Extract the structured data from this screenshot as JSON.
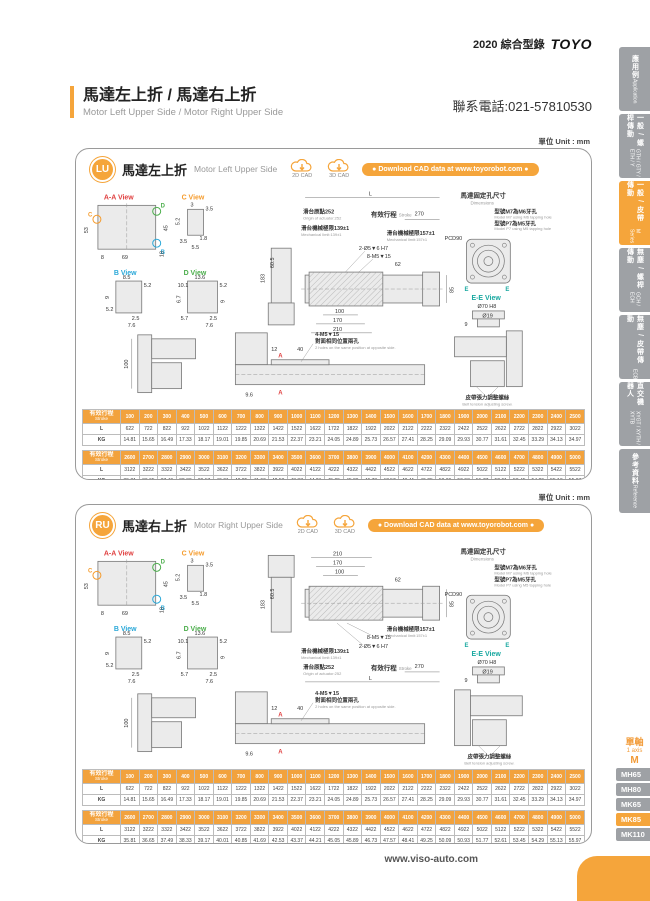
{
  "page": {
    "header": {
      "catalog_year_name": "2020 綜合型錄",
      "brand": "TOYO",
      "phone": "聯系電話:021-57810530"
    },
    "title": {
      "zh": "馬達左上折 / 馬達右上折",
      "en": "Motor Left Upper Side / Motor Right Upper Side"
    },
    "footer": {
      "website": "www.viso-auto.com"
    }
  },
  "sidebar": {
    "tabs": [
      {
        "zh": "應用例",
        "en": "Application",
        "active": false
      },
      {
        "zh": "一般 / 螺桿傳動",
        "en": "GTH / GTY / ETH / Y",
        "active": false
      },
      {
        "zh": "一般 / 皮帶傳動",
        "en": "M Series",
        "active": true
      },
      {
        "zh": "無塵 / 螺桿傳動",
        "en": "GCH / ECH",
        "active": false
      },
      {
        "zh": "無塵 / 皮帶傳動",
        "en": "ECB",
        "active": false
      },
      {
        "zh": "直交機器人",
        "en": "XYGT / XYTH / XYTB",
        "active": false
      },
      {
        "zh": "參考資料",
        "en": "Reference",
        "active": false
      }
    ]
  },
  "series_nav": {
    "group_zh": "單軸",
    "group_en": "1 axis",
    "series": "M",
    "models": [
      "MH65",
      "MH80",
      "MK65",
      "MK85",
      "MK110"
    ],
    "active_model": "MK85"
  },
  "panels": [
    {
      "badge": "LU",
      "title_zh": "馬達左上折",
      "title_en": "Motor Left Upper Side",
      "unit": "單位 Unit : mm",
      "cad_2d": "2D CAD",
      "cad_3d": "3D CAD",
      "download": "● Download CAD data at www.toyorobot.com ●"
    },
    {
      "badge": "RU",
      "title_zh": "馬達右上折",
      "title_en": "Motor Right Upper Side",
      "unit": "單位 Unit : mm",
      "cad_2d": "2D CAD",
      "cad_3d": "3D CAD",
      "download": "● Download CAD data at www.toyorobot.com ●"
    }
  ],
  "drawing": {
    "views": {
      "aa": "A-A View",
      "b": "B View",
      "c": "C View",
      "d": "D View",
      "ee": "E-E View"
    },
    "markers": {
      "a": "A",
      "b": "B",
      "c": "C",
      "d": "D",
      "e": "E"
    },
    "aa": {
      "left": "53",
      "right": "45",
      "b1": "8",
      "b2": "69",
      "b3": "18"
    },
    "c": {
      "d1": "3",
      "d2": "3.5",
      "d3": "5.2",
      "d4": "3.5",
      "d5": "1.8",
      "d6": "5.5"
    },
    "b": {
      "d1": "8.5",
      "d2": "5.2",
      "d3": "9",
      "d4": "5.2",
      "d5": "2.5",
      "d6": "7.6"
    },
    "d": {
      "d1": "13.6",
      "d2": "10.1",
      "d3": "5.2",
      "d4": "6.7",
      "d5": "9",
      "d6": "5.7",
      "d7": "2.5",
      "d8": "7.6"
    },
    "side": {
      "h": "183",
      "w": "60.5"
    },
    "main": {
      "overall": "L",
      "stroke_zh": "有效行程",
      "stroke_en": "Stroke",
      "right_len": "270",
      "origin_zh": "滑台原點252",
      "origin_en": "Origin of actuator:252",
      "limit_l_zh": "滑台機械極限139±1",
      "limit_l_en": "Mechanical limit:139±1",
      "limit_r_zh": "滑台機械極限157±1",
      "limit_r_en": "Mechanical limit:157±1",
      "callout_holes": "2-Ø5▼6 H7",
      "callout_taps": "8-M5▼15",
      "dim62": "62",
      "chain": [
        "100",
        "170",
        "210"
      ],
      "height": "85"
    },
    "mount": {
      "title_zh": "馬達固定孔尺寸",
      "title_en": "Dimensions",
      "note1_zh": "型號M7為M6牙孔",
      "note1_en": "Model M7 using M6 tapping hole",
      "note2_zh": "型號P7為M5牙孔",
      "note2_en": "Model P7 using M5 tapping hole",
      "pcd": "PCD90",
      "dia1": "Ø70 H8",
      "dia2": "Ø19",
      "depth": "9"
    },
    "lower": {
      "motor_h": "100",
      "d12": "12",
      "d40": "40",
      "tap_note": "4-M5▼15",
      "tap_note2_zh": "對面相同位置兩孔",
      "tap_note2_en": "2 holes on the same position at opposite side.",
      "d96": "9.6",
      "belt_zh": "皮帶張力調整螺絲",
      "belt_en": "Belt tension adjusting screw."
    }
  },
  "stroke_tables": [
    {
      "header_zh": "有效行程",
      "header_en": "Stroke",
      "strokes": [
        "100",
        "200",
        "300",
        "400",
        "500",
        "600",
        "700",
        "800",
        "900",
        "1000",
        "1100",
        "1200",
        "1300",
        "1400",
        "1500",
        "1600",
        "1700",
        "1800",
        "1900",
        "2000",
        "2100",
        "2200",
        "2300",
        "2400",
        "2500"
      ],
      "rows": [
        {
          "label": "L",
          "values": [
            "622",
            "722",
            "822",
            "922",
            "1022",
            "1122",
            "1222",
            "1322",
            "1422",
            "1522",
            "1622",
            "1722",
            "1822",
            "1922",
            "2022",
            "2122",
            "2222",
            "2322",
            "2422",
            "2522",
            "2622",
            "2722",
            "2822",
            "2922",
            "3022"
          ]
        },
        {
          "label": "KG",
          "values": [
            "14.81",
            "15.65",
            "16.49",
            "17.33",
            "18.17",
            "19.01",
            "19.85",
            "20.69",
            "21.53",
            "22.37",
            "23.21",
            "24.05",
            "24.89",
            "25.73",
            "26.57",
            "27.41",
            "28.25",
            "29.09",
            "29.93",
            "30.77",
            "31.61",
            "32.45",
            "33.29",
            "34.13",
            "34.97"
          ]
        }
      ]
    },
    {
      "header_zh": "有效行程",
      "header_en": "Stroke",
      "strokes": [
        "2600",
        "2700",
        "2800",
        "2900",
        "3000",
        "3100",
        "3200",
        "3300",
        "3400",
        "3500",
        "3600",
        "3700",
        "3800",
        "3900",
        "4000",
        "4100",
        "4200",
        "4300",
        "4400",
        "4500",
        "4600",
        "4700",
        "4800",
        "4900",
        "5000"
      ],
      "rows": [
        {
          "label": "L",
          "values": [
            "3122",
            "3222",
            "3322",
            "3422",
            "3522",
            "3622",
            "3722",
            "3822",
            "3922",
            "4022",
            "4122",
            "4222",
            "4322",
            "4422",
            "4522",
            "4622",
            "4722",
            "4822",
            "4922",
            "5022",
            "5122",
            "5222",
            "5322",
            "5422",
            "5522"
          ]
        },
        {
          "label": "KG",
          "values": [
            "35.81",
            "36.65",
            "37.49",
            "38.33",
            "39.17",
            "40.01",
            "40.85",
            "41.69",
            "42.53",
            "43.37",
            "44.21",
            "45.05",
            "45.89",
            "46.73",
            "47.57",
            "48.41",
            "49.25",
            "50.09",
            "50.93",
            "51.77",
            "52.61",
            "53.45",
            "54.29",
            "55.13",
            "55.97"
          ]
        }
      ]
    }
  ]
}
